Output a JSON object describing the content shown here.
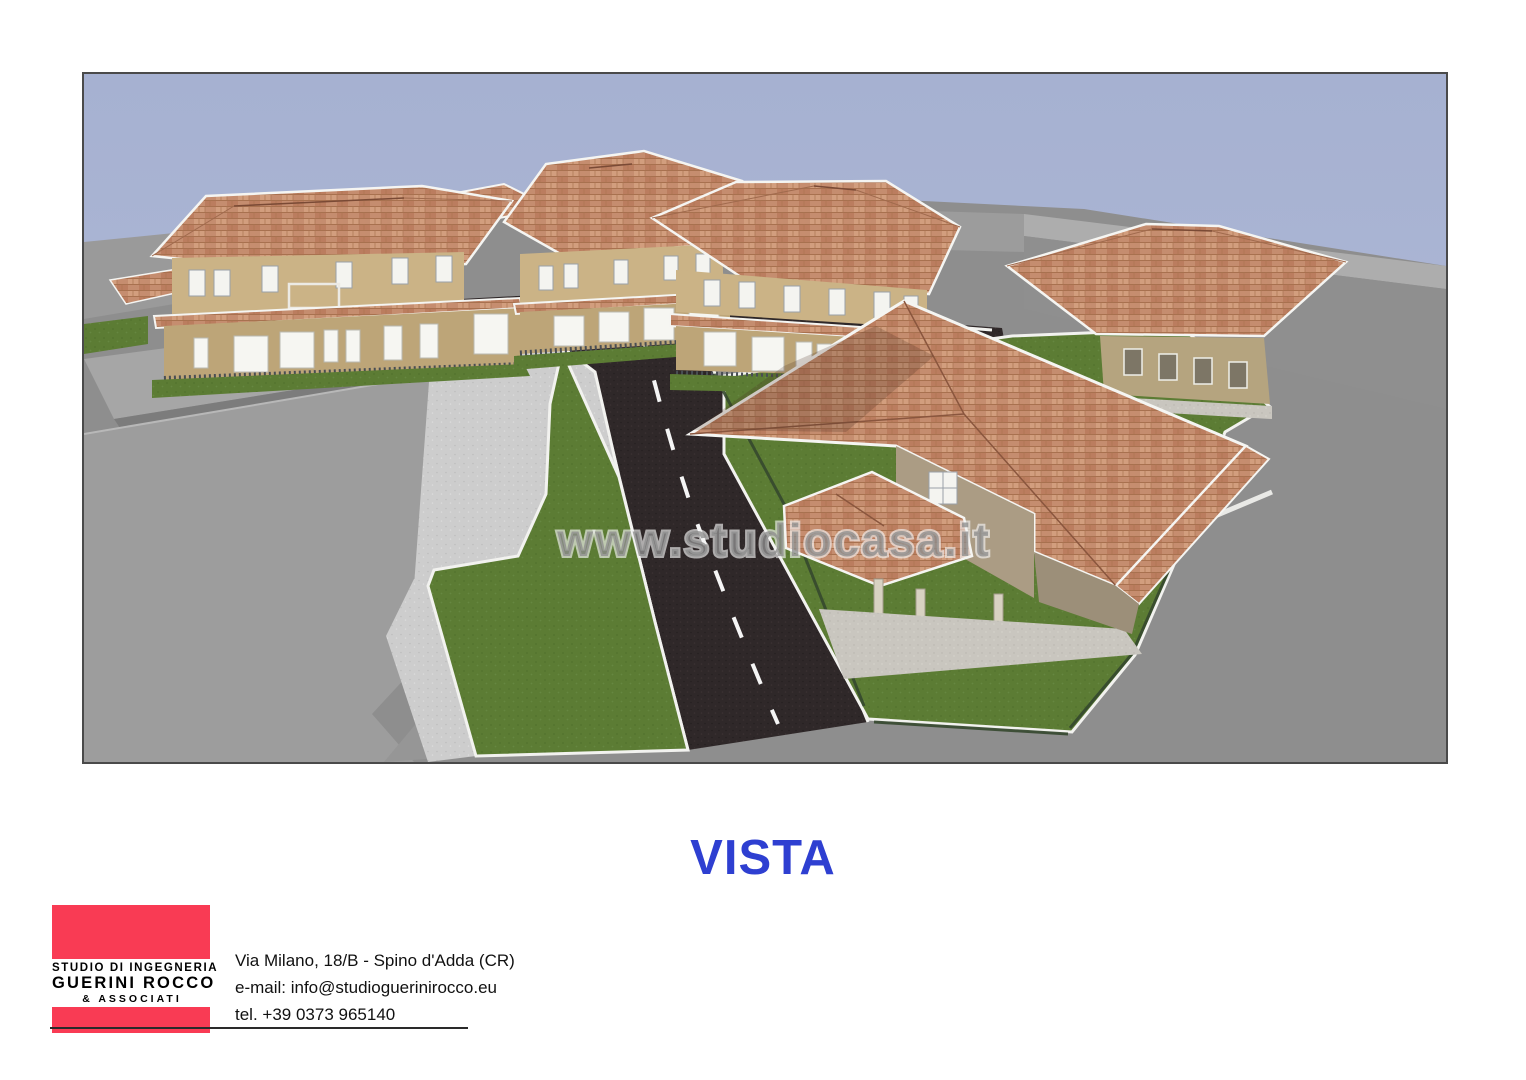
{
  "render": {
    "watermark": "www.studiocasa.it",
    "description": "3D architectural rendering of a residential development: two-story beige houses with terracotta hip roofs, dark asphalt roads with dashed white centerlines, green lawns, gray existing industrial buildings at left"
  },
  "title": {
    "text": "VISTA"
  },
  "footer": {
    "logo": {
      "line1": "STUDIO DI INGEGNERIA",
      "line2": "GUERINI ROCCO",
      "line3": "& ASSOCIATI"
    },
    "contact": {
      "address": "Via Milano, 18/B - Spino d'Adda (CR)",
      "email": "e-mail: info@studioguerinirocco.eu",
      "phone": "tel. +39 0373 965140"
    }
  },
  "colors": {
    "title_blue": "#2E3FD1",
    "logo_pink": "#F93B54",
    "sky": "#A9B3D2",
    "ground_gray": "#8E8E8E",
    "roof_terracotta": "#C58D6F",
    "wall_beige": "#CBB386",
    "lawn_green": "#5C7C34",
    "road_asphalt": "#2F2829",
    "trim_white": "#F5F5F2"
  }
}
